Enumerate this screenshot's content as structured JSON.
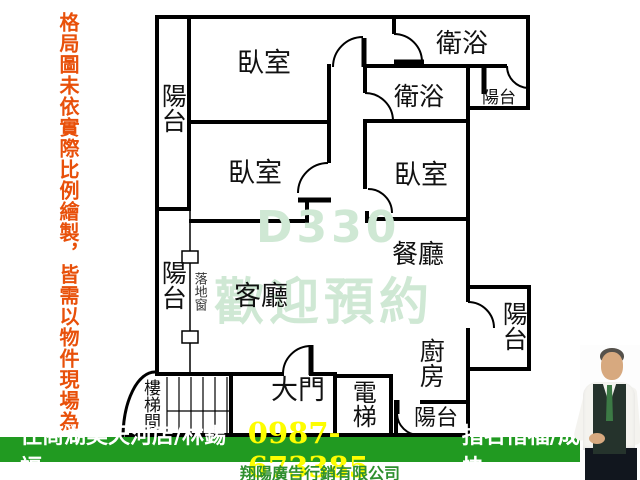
{
  "disclaimer": {
    "text": "格局圖未依實際比例繪製，皆需以物件現場為",
    "color": "#e8500a"
  },
  "floorplan": {
    "rooms": {
      "bedroom1": "臥室",
      "bedroom2": "臥室",
      "bedroom3": "臥室",
      "bathroom1": "衛浴",
      "bathroom2": "衛浴",
      "balcony_top_left": "陽台",
      "balcony_mid_left": "陽台",
      "balcony_top_right": "陽台",
      "balcony_right": "陽台",
      "balcony_bottom": "陽台",
      "living_room": "客廳",
      "dining_room": "餐廳",
      "kitchen": "廚房",
      "main_door": "大門",
      "elevator": "電梯",
      "stairwell": "樓梯間",
      "window_label": "落地窗"
    },
    "watermark": {
      "line1": "D330",
      "line2": "歡迎預約",
      "color": "#cfe8d4"
    }
  },
  "footer": {
    "bar_color": "#219a21",
    "agency": "住商湖美天河店/林錫福",
    "phone": "0987-673385",
    "phone_color": "#fdfd00",
    "slogan": "指名惜福/成交最快",
    "company": "翔陽廣告行銷有限公司"
  }
}
